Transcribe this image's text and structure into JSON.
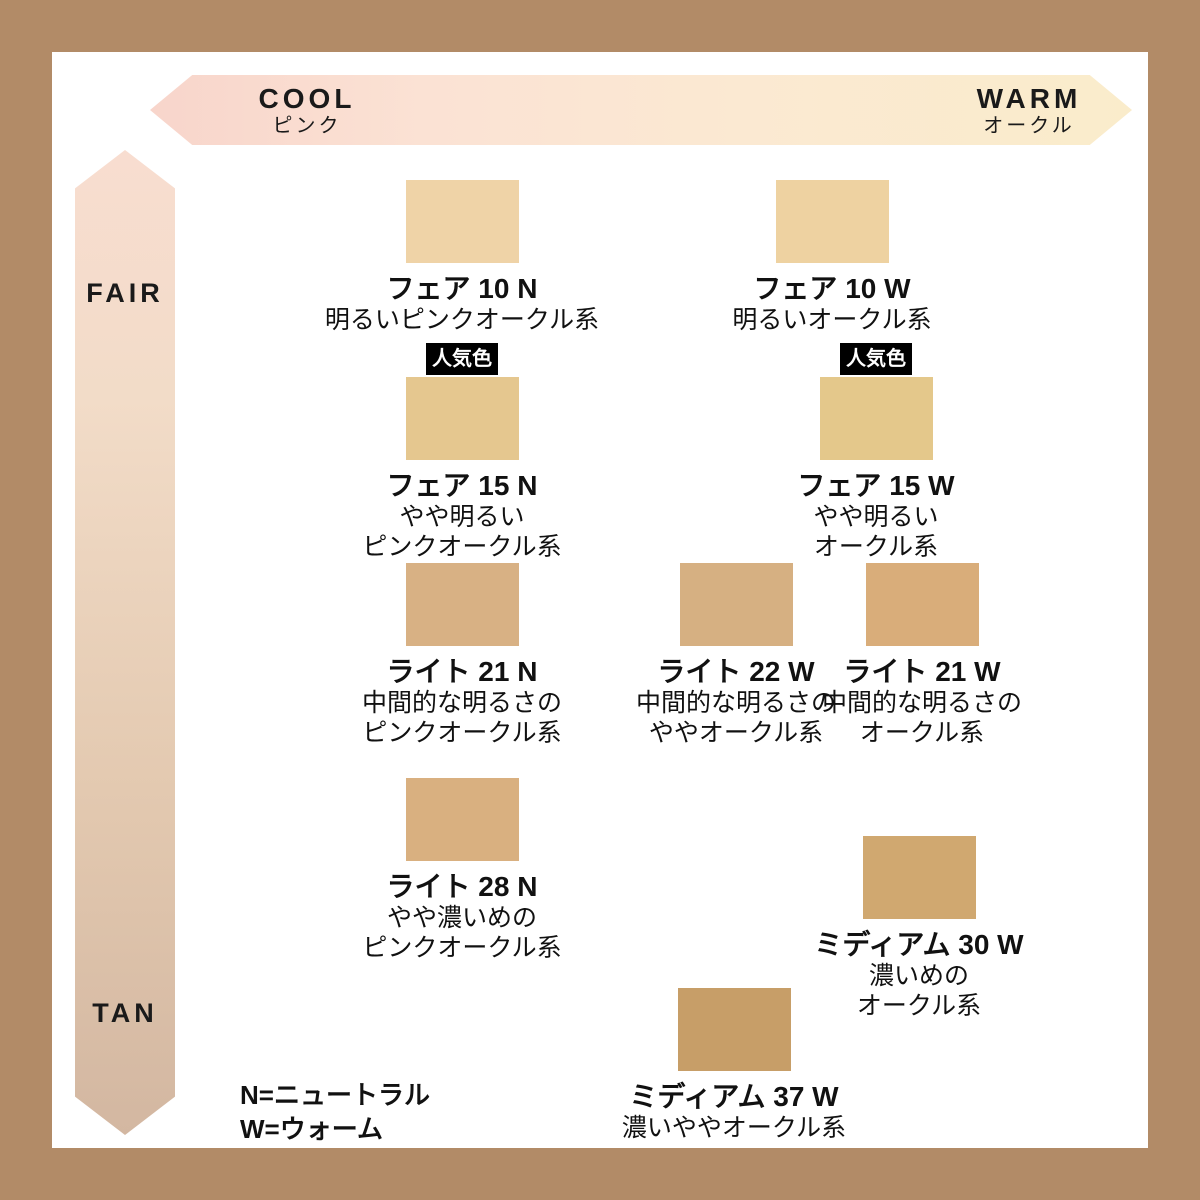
{
  "colors": {
    "frame": "#b28b67",
    "background": "#ffffff",
    "text": "#111111",
    "badge_bg": "#000000",
    "badge_text": "#ffffff"
  },
  "horizontal_axis": {
    "left_label": "COOL",
    "left_sublabel": "ピンク",
    "right_label": "WARM",
    "right_sublabel": "オークル",
    "gradient": [
      "#f8d5cb",
      "#faeccb"
    ]
  },
  "vertical_axis": {
    "top_label": "FAIR",
    "bottom_label": "TAN",
    "gradient": [
      "#f8ddd0",
      "#d3b7a1"
    ]
  },
  "popular_badge_label": "人気色",
  "legend": {
    "lines": [
      "N=ニュートラル",
      "W=ウォーム"
    ]
  },
  "shades": [
    {
      "id": "fair-10-n",
      "name": "フェア 10 N",
      "desc": [
        "明るいピンクオークル系"
      ],
      "color": "#efd3a7",
      "popular": false,
      "x": 462,
      "y": 180
    },
    {
      "id": "fair-10-w",
      "name": "フェア 10 W",
      "desc": [
        "明るいオークル系"
      ],
      "color": "#eed2a1",
      "popular": false,
      "x": 832,
      "y": 180
    },
    {
      "id": "fair-15-n",
      "name": "フェア 15 N",
      "desc": [
        "やや明るい",
        "ピンクオークル系"
      ],
      "color": "#e5c78f",
      "popular": true,
      "x": 462,
      "y": 377
    },
    {
      "id": "fair-15-w",
      "name": "フェア 15 W",
      "desc": [
        "やや明るい",
        "オークル系"
      ],
      "color": "#e4c88b",
      "popular": true,
      "x": 876,
      "y": 377
    },
    {
      "id": "light-21-n",
      "name": "ライト 21 N",
      "desc": [
        "中間的な明るさの",
        "ピンクオークル系"
      ],
      "color": "#d8b184",
      "popular": false,
      "x": 462,
      "y": 563
    },
    {
      "id": "light-22-w",
      "name": "ライト 22 W",
      "desc": [
        "中間的な明るさの",
        "ややオークル系"
      ],
      "color": "#d6b082",
      "popular": false,
      "x": 736,
      "y": 563
    },
    {
      "id": "light-21-w",
      "name": "ライト 21 W",
      "desc": [
        "中間的な明るさの",
        "オークル系"
      ],
      "color": "#d9ad7a",
      "popular": false,
      "x": 922,
      "y": 563
    },
    {
      "id": "light-28-n",
      "name": "ライト 28 N",
      "desc": [
        "やや濃いめの",
        "ピンクオークル系"
      ],
      "color": "#d9b080",
      "popular": false,
      "x": 462,
      "y": 778
    },
    {
      "id": "medium-30-w",
      "name": "ミディアム 30 W",
      "desc": [
        "濃いめの",
        "オークル系"
      ],
      "color": "#d0a870",
      "popular": false,
      "x": 919,
      "y": 836
    },
    {
      "id": "medium-37-w",
      "name": "ミディアム 37 W",
      "desc": [
        "濃いややオークル系"
      ],
      "color": "#c79e68",
      "popular": false,
      "x": 734,
      "y": 988
    }
  ]
}
